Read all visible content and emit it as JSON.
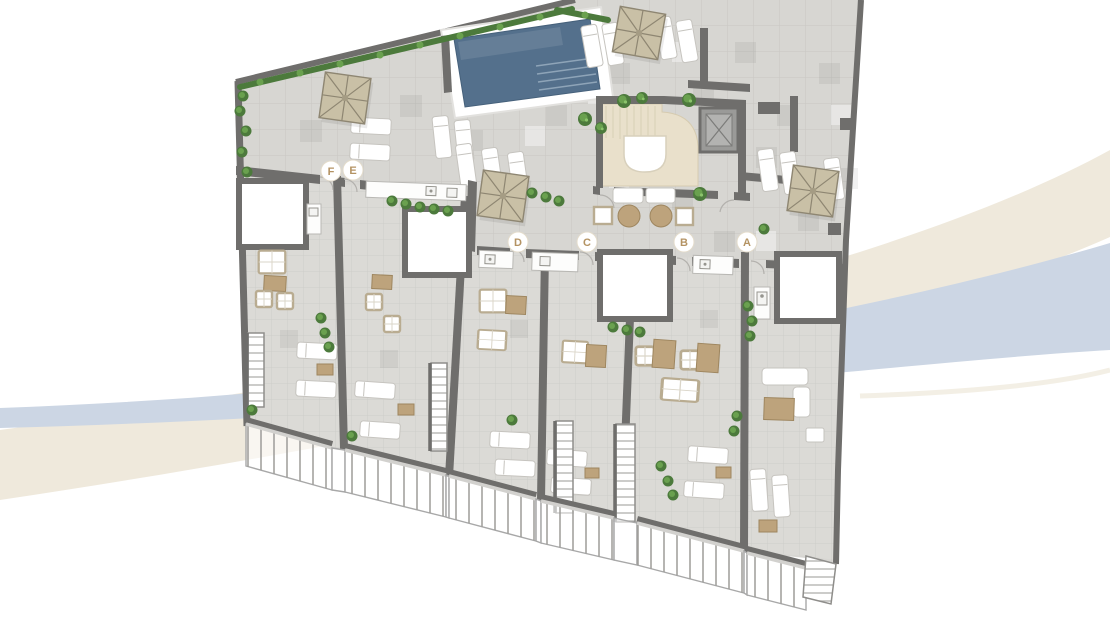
{
  "plan": {
    "unit_markers": [
      {
        "label": "F",
        "x": 331,
        "y": 171
      },
      {
        "label": "E",
        "x": 353,
        "y": 170
      },
      {
        "label": "D",
        "x": 518,
        "y": 242
      },
      {
        "label": "C",
        "x": 587,
        "y": 242
      },
      {
        "label": "B",
        "x": 684,
        "y": 242
      },
      {
        "label": "A",
        "x": 747,
        "y": 242
      }
    ],
    "features": [
      "swimming-pool",
      "pool-steps",
      "stair-core",
      "elevator",
      "parasols",
      "sun-loungers",
      "outdoor-dining-sets",
      "sofas",
      "skylights",
      "outdoor-kitchens",
      "staircases",
      "glass-balustrades",
      "hedges",
      "planters"
    ]
  },
  "colors": {
    "background": "#ffffff",
    "swoosh_beige": "#efe9dc",
    "swoosh_blue": "#ccd6e4",
    "wall": "#6f6e6c",
    "floor": "#d7d6d2",
    "floor_grid": "#c8c7c3",
    "terrace_floor": "#dbdad6",
    "terrace_grid": "#cecdc9",
    "pool_water": "#54708c",
    "core_floor": "#e9e0cb",
    "greenery": "#4c7a3c",
    "greenery_light": "#6aa14f",
    "parasol": "#c9c0a6",
    "parasol_rib": "#8e8672",
    "furniture_tan": "#bda37c",
    "furniture_white": "#ffffff",
    "furniture_frame": "#b9ac91",
    "elevator": "#9a9a98",
    "railing_glass": "rgba(255,255,255,0.6)",
    "railing_frame": "#a8a8a8",
    "marker_bg": "#ffffff",
    "marker_letter": "#b49363"
  }
}
